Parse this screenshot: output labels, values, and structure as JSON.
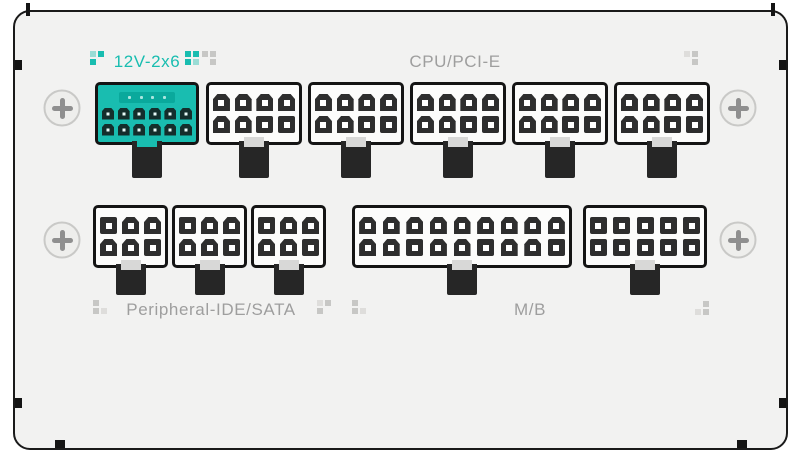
{
  "labels": {
    "twelve_v_2x6": "12V-2x6",
    "cpu_pcie": "CPU/PCI-E",
    "peripheral": "Peripheral-IDE/SATA",
    "motherboard": "M/B"
  },
  "colors": {
    "teal": "#19bdb0",
    "teal_light": "#9adcd5",
    "teal_slot": "#0aa99c",
    "teal_pin": "#142e2c",
    "gray_dot": "#c7c7c5",
    "gray_dot_light": "#dedddb",
    "label_gray": "#9e9e9e",
    "panel_bg": "#f2f2f1",
    "connector_body": "#fcfcfb",
    "pin_dark": "#2e2e2e",
    "border_black": "#1a1a1a"
  },
  "connectors": {
    "top_row": [
      {
        "name": "12v-2x6-connector",
        "x": 95,
        "w": 104,
        "style": "teal",
        "pin_size": 12,
        "hole": 3,
        "sense_pins": 4,
        "rows": [
          [
            "c",
            "c",
            "c",
            "c",
            "c",
            "c"
          ],
          [
            "c",
            "c",
            "c",
            "c",
            "c",
            "c"
          ]
        ]
      },
      {
        "name": "cpu-pcie-connector-1",
        "x": 206,
        "w": 96,
        "style": "dark",
        "pin_size": 17,
        "hole": 6,
        "rows": [
          [
            "c",
            "c",
            "c",
            "c"
          ],
          [
            "c",
            "c",
            "s",
            "s"
          ]
        ]
      },
      {
        "name": "cpu-pcie-connector-2",
        "x": 308,
        "w": 96,
        "style": "dark",
        "pin_size": 17,
        "hole": 6,
        "rows": [
          [
            "c",
            "c",
            "c",
            "c"
          ],
          [
            "c",
            "c",
            "s",
            "s"
          ]
        ]
      },
      {
        "name": "cpu-pcie-connector-3",
        "x": 410,
        "w": 96,
        "style": "dark",
        "pin_size": 17,
        "hole": 6,
        "rows": [
          [
            "c",
            "c",
            "c",
            "c"
          ],
          [
            "c",
            "c",
            "s",
            "s"
          ]
        ]
      },
      {
        "name": "cpu-pcie-connector-4",
        "x": 512,
        "w": 96,
        "style": "dark",
        "pin_size": 17,
        "hole": 6,
        "rows": [
          [
            "c",
            "c",
            "c",
            "c"
          ],
          [
            "c",
            "c",
            "s",
            "s"
          ]
        ]
      },
      {
        "name": "cpu-pcie-connector-5",
        "x": 614,
        "w": 96,
        "style": "dark",
        "pin_size": 17,
        "hole": 6,
        "rows": [
          [
            "c",
            "c",
            "c",
            "c"
          ],
          [
            "c",
            "c",
            "s",
            "s"
          ]
        ]
      }
    ],
    "bottom_row": [
      {
        "name": "peripheral-connector-1",
        "x": 93,
        "w": 75,
        "style": "dark",
        "pin_size": 17,
        "hole": 6,
        "rows": [
          [
            "s",
            "c",
            "c"
          ],
          [
            "c",
            "c",
            "s"
          ]
        ]
      },
      {
        "name": "peripheral-connector-2",
        "x": 172,
        "w": 75,
        "style": "dark",
        "pin_size": 17,
        "hole": 6,
        "rows": [
          [
            "s",
            "c",
            "c"
          ],
          [
            "c",
            "c",
            "s"
          ]
        ]
      },
      {
        "name": "peripheral-connector-3",
        "x": 251,
        "w": 75,
        "style": "dark",
        "pin_size": 17,
        "hole": 6,
        "rows": [
          [
            "s",
            "c",
            "c"
          ],
          [
            "c",
            "c",
            "s"
          ]
        ]
      },
      {
        "name": "mb-connector",
        "x": 352,
        "w": 220,
        "style": "dark",
        "pin_size": 17,
        "hole": 6,
        "rows": [
          [
            "c",
            "c",
            "c",
            "c",
            "c",
            "c",
            "c",
            "c",
            "c"
          ],
          [
            "c",
            "c",
            "s",
            "c",
            "c",
            "s",
            "c",
            "c",
            "s"
          ]
        ]
      },
      {
        "name": "aux-10pin-connector",
        "x": 583,
        "w": 124,
        "style": "dark",
        "pin_size": 17,
        "hole": 6,
        "rows": [
          [
            "s",
            "s",
            "s",
            "s",
            "s"
          ],
          [
            "s",
            "s",
            "s",
            "s",
            "s"
          ]
        ]
      }
    ]
  },
  "screws": [
    {
      "x": 62,
      "y": 108
    },
    {
      "x": 738,
      "y": 108
    },
    {
      "x": 62,
      "y": 240
    },
    {
      "x": 738,
      "y": 240
    }
  ],
  "decor_clusters": [
    {
      "x": 90,
      "y": 51,
      "cells": [
        "tl",
        "t",
        "t",
        null
      ]
    },
    {
      "x": 185,
      "y": 51,
      "cells": [
        "t",
        "t",
        "t",
        "tl"
      ]
    },
    {
      "x": 202,
      "y": 51,
      "cells": [
        "g",
        "g",
        null,
        "g"
      ]
    },
    {
      "x": 684,
      "y": 51,
      "cells": [
        "gl",
        "g",
        null,
        "g"
      ]
    },
    {
      "x": 93,
      "y": 300,
      "cells": [
        "g",
        null,
        "g",
        "gl"
      ]
    },
    {
      "x": 317,
      "y": 300,
      "cells": [
        "gl",
        "g",
        "g",
        null
      ]
    },
    {
      "x": 352,
      "y": 300,
      "cells": [
        "g",
        null,
        "g",
        "gl"
      ]
    },
    {
      "x": 695,
      "y": 301,
      "cells": [
        null,
        "g",
        "gl",
        "g"
      ]
    }
  ]
}
